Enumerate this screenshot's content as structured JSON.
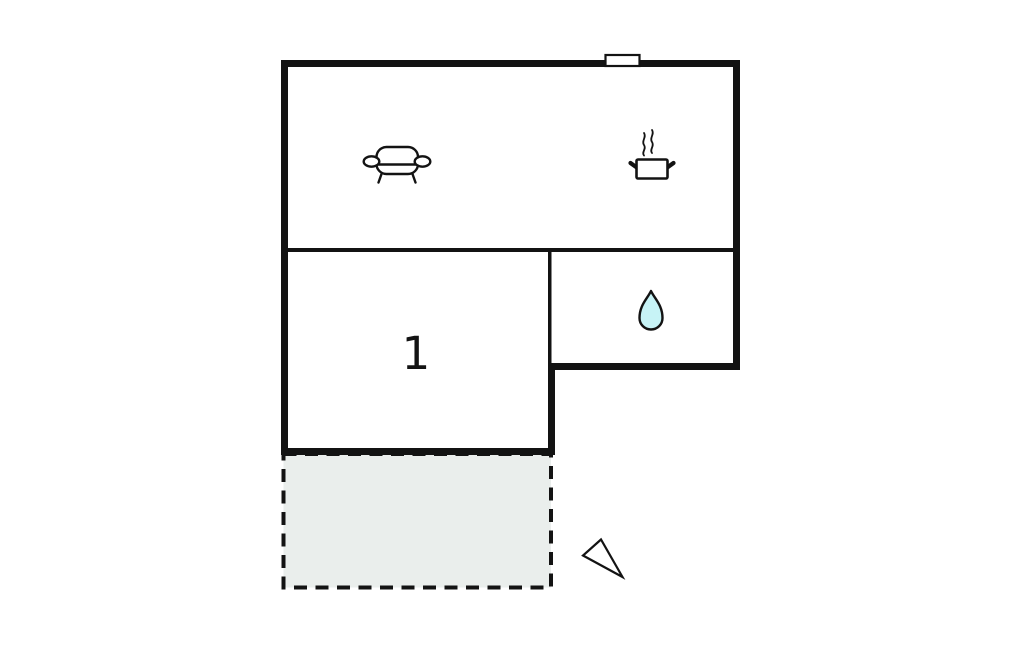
{
  "rooms": {
    "room1_label": "1"
  },
  "colors": {
    "background": "#ffffff",
    "wall": "#131313",
    "terrace_fill": "#eaeeec",
    "water_drop_fill": "#c7f3f6",
    "icon_fill": "#ffffff"
  },
  "icons": {
    "sofa": "sofa-icon",
    "cooking_pot": "cooking-pot-icon",
    "steam": "steam-lines-icon",
    "water_drop": "water-drop-icon",
    "window": "window-marker-icon",
    "north_arrow": "north-arrow-icon"
  }
}
